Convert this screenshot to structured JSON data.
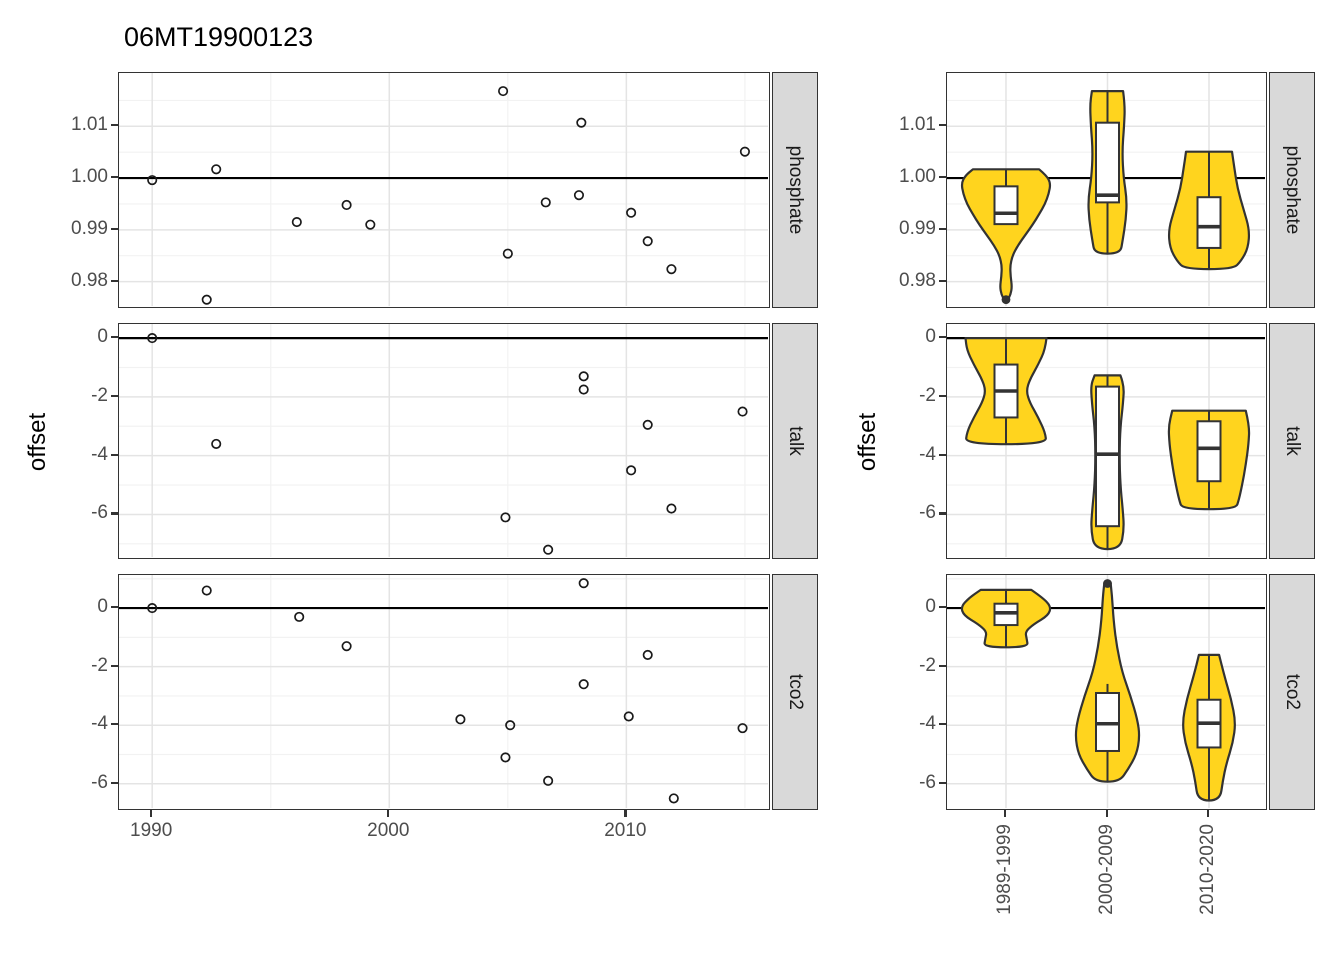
{
  "title": "06MT19900123",
  "y_axis_title": "offset",
  "facets": [
    "phosphate",
    "talk",
    "tco2"
  ],
  "x_tick_labels_left": [
    "1990",
    "2000",
    "2010"
  ],
  "categories": [
    "1989-1999",
    "2000-2009",
    "2010-2020"
  ],
  "colors": {
    "violin_fill": "#FFD41E",
    "outline": "#333333",
    "strip_fill": "#D9D9D9",
    "grid_major": "#E4E4E4",
    "grid_minor": "#F2F2F2",
    "tick_text": "#4D4D4D",
    "ref_line": "#000000",
    "point_stroke": "#1A1A1A",
    "box_fill": "#FFFFFF"
  },
  "chart_data": [
    {
      "type": "scatter",
      "title": "06MT19900123",
      "xlabel": "",
      "ylabel": "offset",
      "x_breaks": [
        1990,
        2000,
        2010
      ],
      "x_minor": [
        1995,
        2005,
        2015
      ],
      "xlim": [
        1988.6,
        2016.1
      ],
      "grid": true,
      "facets": [
        {
          "name": "phosphate",
          "ylim": [
            0.9747,
            1.0203
          ],
          "yticks": [
            1.01,
            1.0,
            0.99,
            0.98
          ],
          "ytick_labels": [
            "1.01",
            "1.00",
            "0.99",
            "0.98"
          ],
          "yminor": [
            1.015,
            1.005,
            0.995,
            0.985,
            0.975
          ],
          "ref_line": 1.0,
          "points": [
            [
              1990.0,
              0.9996
            ],
            [
              1992.3,
              0.9765
            ],
            [
              1992.7,
              1.0017
            ],
            [
              1996.1,
              0.9915
            ],
            [
              1998.2,
              0.9948
            ],
            [
              1999.2,
              0.991
            ],
            [
              2004.8,
              1.0168
            ],
            [
              2005.0,
              0.9854
            ],
            [
              2006.6,
              0.9953
            ],
            [
              2008.0,
              0.9967
            ],
            [
              2008.1,
              1.0107
            ],
            [
              2010.2,
              0.9933
            ],
            [
              2010.9,
              0.9878
            ],
            [
              2011.9,
              0.9824
            ],
            [
              2015.0,
              1.0051
            ]
          ]
        },
        {
          "name": "talk",
          "ylim": [
            -7.55,
            0.48
          ],
          "yticks": [
            0,
            -2,
            -4,
            -6
          ],
          "ytick_labels": [
            "0",
            "-2",
            "-4",
            "-6"
          ],
          "yminor": [
            -1,
            -3,
            -5,
            -7
          ],
          "ref_line": 0,
          "points": [
            [
              1990.0,
              0.0
            ],
            [
              1992.7,
              -3.6
            ],
            [
              2004.9,
              -6.1
            ],
            [
              2006.7,
              -7.2
            ],
            [
              2008.2,
              -1.3
            ],
            [
              2008.2,
              -1.75
            ],
            [
              2010.2,
              -4.5
            ],
            [
              2010.9,
              -2.95
            ],
            [
              2011.9,
              -5.8
            ],
            [
              2014.9,
              -2.5
            ]
          ]
        },
        {
          "name": "tco2",
          "ylim": [
            -6.93,
            1.13
          ],
          "yticks": [
            0,
            -2,
            -4,
            -6
          ],
          "ytick_labels": [
            "0",
            "-2",
            "-4",
            "-6"
          ],
          "yminor": [
            1,
            -1,
            -3,
            -5
          ],
          "ref_line": 0,
          "points": [
            [
              1990.0,
              0.0
            ],
            [
              1992.3,
              0.6
            ],
            [
              1996.2,
              -0.3
            ],
            [
              1998.2,
              -1.3
            ],
            [
              2003.0,
              -3.8
            ],
            [
              2004.9,
              -5.1
            ],
            [
              2005.1,
              -4.0
            ],
            [
              2006.7,
              -5.9
            ],
            [
              2008.2,
              0.85
            ],
            [
              2008.2,
              -2.6
            ],
            [
              2010.1,
              -3.7
            ],
            [
              2010.9,
              -1.6
            ],
            [
              2012.0,
              -6.5
            ],
            [
              2014.9,
              -4.1
            ]
          ]
        }
      ]
    },
    {
      "type": "violin",
      "categories": [
        "1989-1999",
        "2000-2009",
        "2010-2020"
      ],
      "facets": [
        {
          "name": "phosphate",
          "ref_line": 1.0,
          "violins": [
            {
              "category": "1989-1999",
              "profile": [
                [
                  1.0017,
                  0.72
                ],
                [
                  1.0005,
                  0.88
                ],
                [
                  0.999,
                  0.97
                ],
                [
                  0.997,
                  0.93
                ],
                [
                  0.995,
                  0.85
                ],
                [
                  0.993,
                  0.72
                ],
                [
                  0.991,
                  0.58
                ],
                [
                  0.989,
                  0.42
                ],
                [
                  0.987,
                  0.26
                ],
                [
                  0.985,
                  0.14
                ],
                [
                  0.983,
                  0.09
                ],
                [
                  0.981,
                  0.1
                ],
                [
                  0.979,
                  0.13
                ],
                [
                  0.9775,
                  0.1
                ],
                [
                  0.9765,
                  0.04
                ]
              ],
              "box": {
                "median": 0.9932,
                "q1": 0.9911,
                "q3": 0.9984,
                "whisker_low": 0.991,
                "whisker_high": 1.0017
              },
              "outliers": [
                0.9765
              ]
            },
            {
              "category": "2000-2009",
              "profile": [
                [
                  1.0168,
                  0.34
                ],
                [
                  1.014,
                  0.38
                ],
                [
                  1.01,
                  0.36
                ],
                [
                  1.005,
                  0.32
                ],
                [
                  1.0,
                  0.35
                ],
                [
                  0.996,
                  0.42
                ],
                [
                  0.992,
                  0.4
                ],
                [
                  0.988,
                  0.33
                ],
                [
                  0.9854,
                  0.28
                ]
              ],
              "box": {
                "median": 0.9967,
                "q1": 0.9953,
                "q3": 1.0107,
                "whisker_low": 0.9854,
                "whisker_high": 1.0168
              },
              "outliers": []
            },
            {
              "category": "2010-2020",
              "profile": [
                [
                  1.0051,
                  0.5
                ],
                [
                  1.002,
                  0.55
                ],
                [
                  0.998,
                  0.62
                ],
                [
                  0.994,
                  0.75
                ],
                [
                  0.99,
                  0.88
                ],
                [
                  0.9865,
                  0.85
                ],
                [
                  0.984,
                  0.7
                ],
                [
                  0.9824,
                  0.52
                ]
              ],
              "box": {
                "median": 0.9906,
                "q1": 0.9865,
                "q3": 0.9963,
                "whisker_low": 0.9824,
                "whisker_high": 1.0051
              },
              "outliers": []
            }
          ]
        },
        {
          "name": "talk",
          "ref_line": 0,
          "violins": [
            {
              "category": "1989-1999",
              "profile": [
                [
                  0,
                  0.88
                ],
                [
                  -0.4,
                  0.85
                ],
                [
                  -0.9,
                  0.7
                ],
                [
                  -1.4,
                  0.52
                ],
                [
                  -1.8,
                  0.44
                ],
                [
                  -2.2,
                  0.52
                ],
                [
                  -2.7,
                  0.7
                ],
                [
                  -3.2,
                  0.85
                ],
                [
                  -3.61,
                  0.88
                ]
              ],
              "box": {
                "median": -1.8,
                "q1": -2.7,
                "q3": -0.9,
                "whisker_low": -3.61,
                "whisker_high": 0.0
              },
              "outliers": []
            },
            {
              "category": "2000-2009",
              "profile": [
                [
                  -1.27,
                  0.28
                ],
                [
                  -1.6,
                  0.36
                ],
                [
                  -2.2,
                  0.34
                ],
                [
                  -3.0,
                  0.28
                ],
                [
                  -4.0,
                  0.26
                ],
                [
                  -5.0,
                  0.28
                ],
                [
                  -5.8,
                  0.33
                ],
                [
                  -6.5,
                  0.36
                ],
                [
                  -7.18,
                  0.28
                ]
              ],
              "box": {
                "median": -3.95,
                "q1": -6.4,
                "q3": -1.65,
                "whisker_low": -7.18,
                "whisker_high": -1.27
              },
              "outliers": []
            },
            {
              "category": "2010-2020",
              "profile": [
                [
                  -2.47,
                  0.8
                ],
                [
                  -3.0,
                  0.88
                ],
                [
                  -3.6,
                  0.86
                ],
                [
                  -4.3,
                  0.8
                ],
                [
                  -5.0,
                  0.72
                ],
                [
                  -5.5,
                  0.65
                ],
                [
                  -5.82,
                  0.58
                ]
              ],
              "box": {
                "median": -3.75,
                "q1": -4.87,
                "q3": -2.83,
                "whisker_low": -5.82,
                "whisker_high": -2.47
              },
              "outliers": []
            }
          ]
        },
        {
          "name": "tco2",
          "ref_line": 0,
          "violins": [
            {
              "category": "1989-1999",
              "profile": [
                [
                  0.62,
                  0.55
                ],
                [
                  0.35,
                  0.8
                ],
                [
                  0.05,
                  0.98
                ],
                [
                  -0.25,
                  0.92
                ],
                [
                  -0.55,
                  0.6
                ],
                [
                  -0.8,
                  0.42
                ],
                [
                  -1.05,
                  0.45
                ],
                [
                  -1.34,
                  0.48
                ]
              ],
              "box": {
                "median": -0.16,
                "q1": -0.58,
                "q3": 0.15,
                "whisker_low": -1.34,
                "whisker_high": 0.62
              },
              "outliers": []
            },
            {
              "category": "2000-2009",
              "profile": [
                [
                  0.84,
                  0.07
                ],
                [
                  0.4,
                  0.1
                ],
                [
                  -0.4,
                  0.13
                ],
                [
                  -1.3,
                  0.2
                ],
                [
                  -2.2,
                  0.32
                ],
                [
                  -3.0,
                  0.5
                ],
                [
                  -3.8,
                  0.65
                ],
                [
                  -4.4,
                  0.7
                ],
                [
                  -5.0,
                  0.63
                ],
                [
                  -5.5,
                  0.45
                ],
                [
                  -5.93,
                  0.26
                ]
              ],
              "box": {
                "median": -3.95,
                "q1": -4.88,
                "q3": -2.9,
                "whisker_low": -5.93,
                "whisker_high": -2.59
              },
              "outliers": [
                0.84
              ]
            },
            {
              "category": "2010-2020",
              "profile": [
                [
                  -1.6,
                  0.22
                ],
                [
                  -2.3,
                  0.33
                ],
                [
                  -3.1,
                  0.48
                ],
                [
                  -3.9,
                  0.58
                ],
                [
                  -4.6,
                  0.52
                ],
                [
                  -5.3,
                  0.38
                ],
                [
                  -5.9,
                  0.3
                ],
                [
                  -6.57,
                  0.24
                ]
              ],
              "box": {
                "median": -3.93,
                "q1": -4.76,
                "q3": -3.13,
                "whisker_low": -6.57,
                "whisker_high": -1.6
              },
              "outliers": []
            }
          ]
        }
      ]
    }
  ]
}
